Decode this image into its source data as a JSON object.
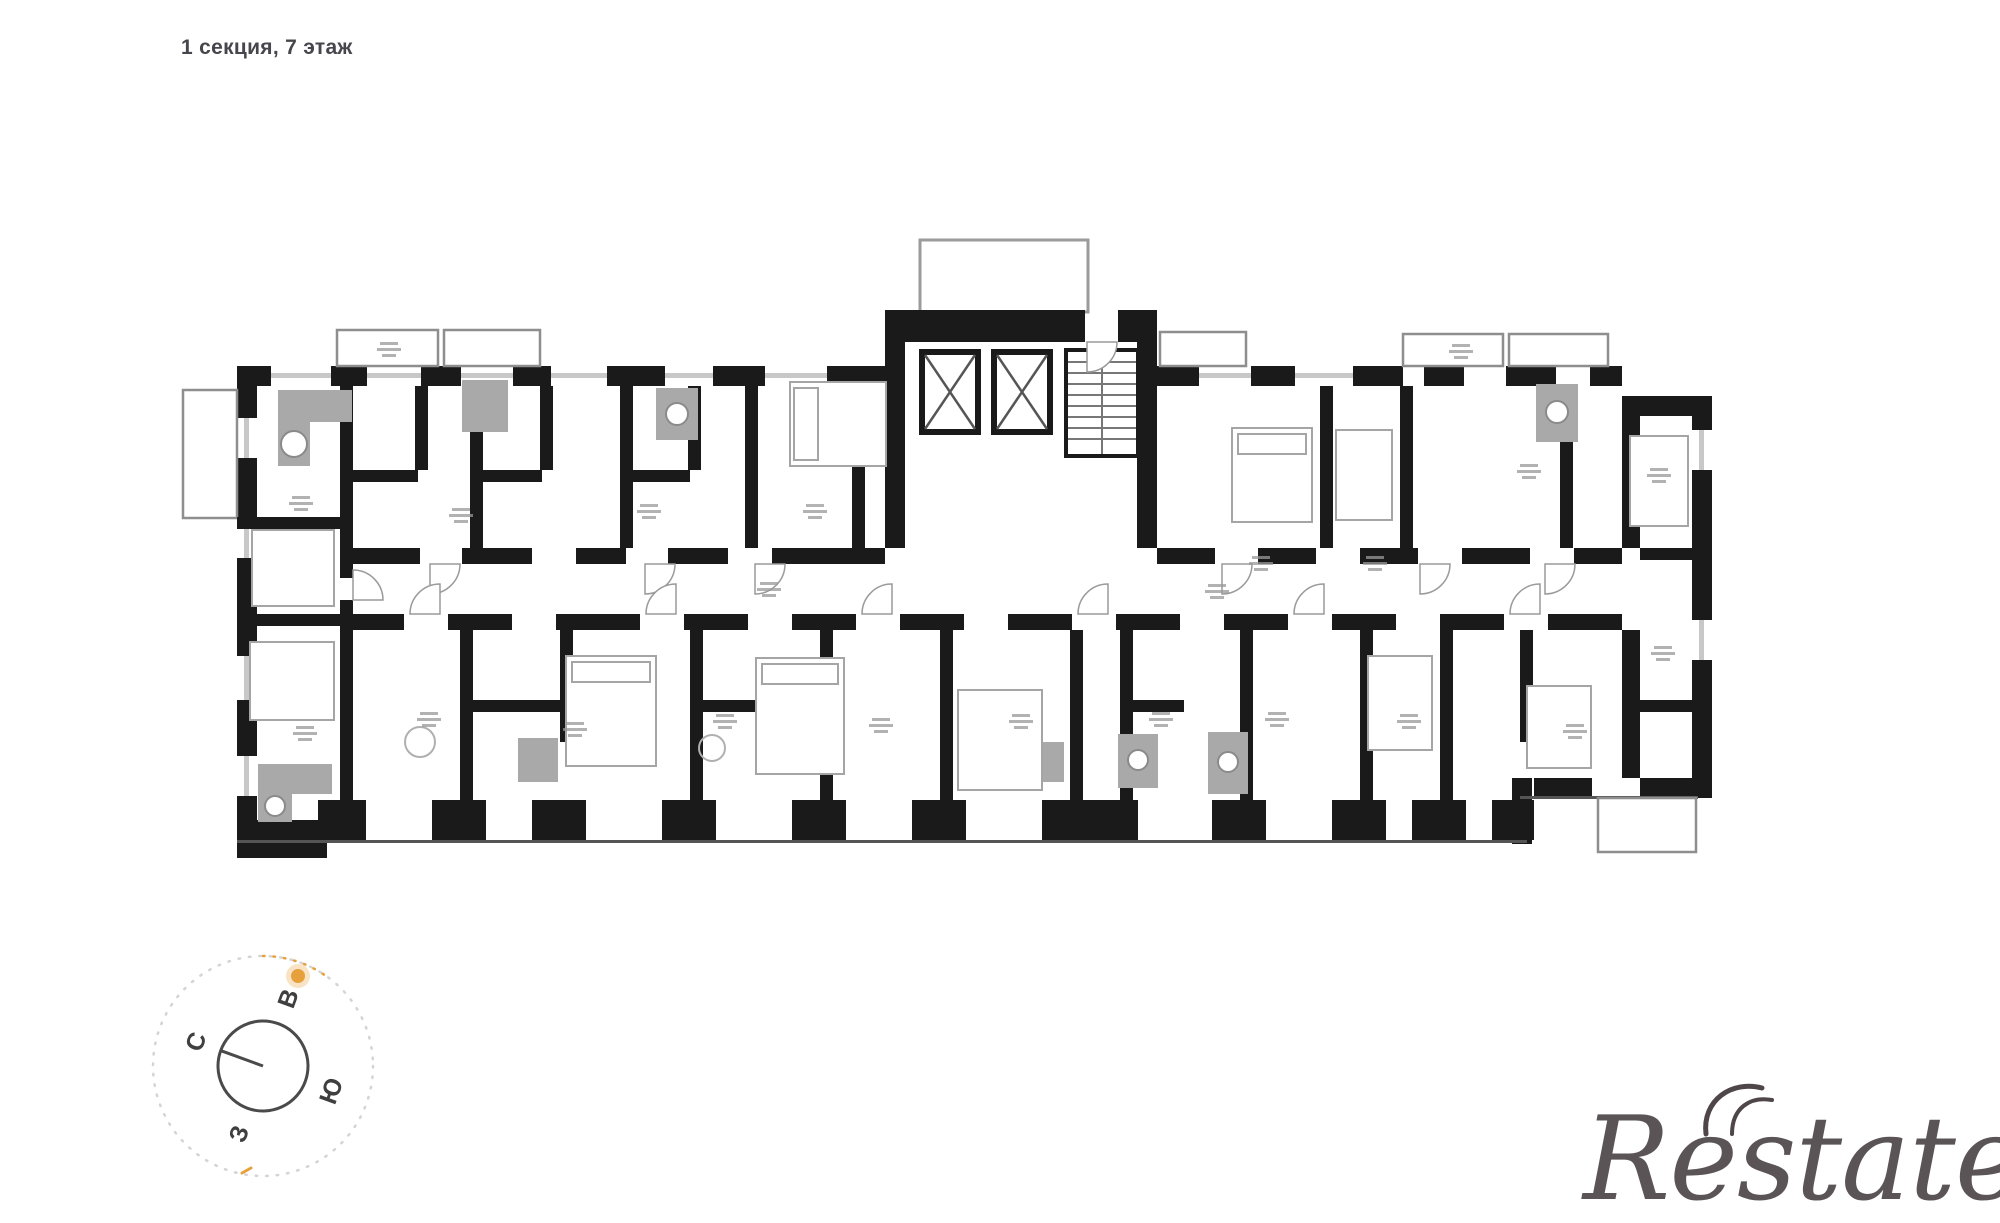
{
  "header": {
    "title": "1 секция, 7 этаж"
  },
  "compass": {
    "north": "С",
    "east": "В",
    "south": "Ю",
    "west": "З"
  },
  "watermark": {
    "text": "Restate"
  },
  "colors": {
    "walls": "#1a1a1a",
    "furniture": "#a9a9a9",
    "thin_lines": "#9a9a9a",
    "sun_accent": "#e7a13c",
    "title_text": "#46464c",
    "watermark_text": "#4e4649"
  }
}
